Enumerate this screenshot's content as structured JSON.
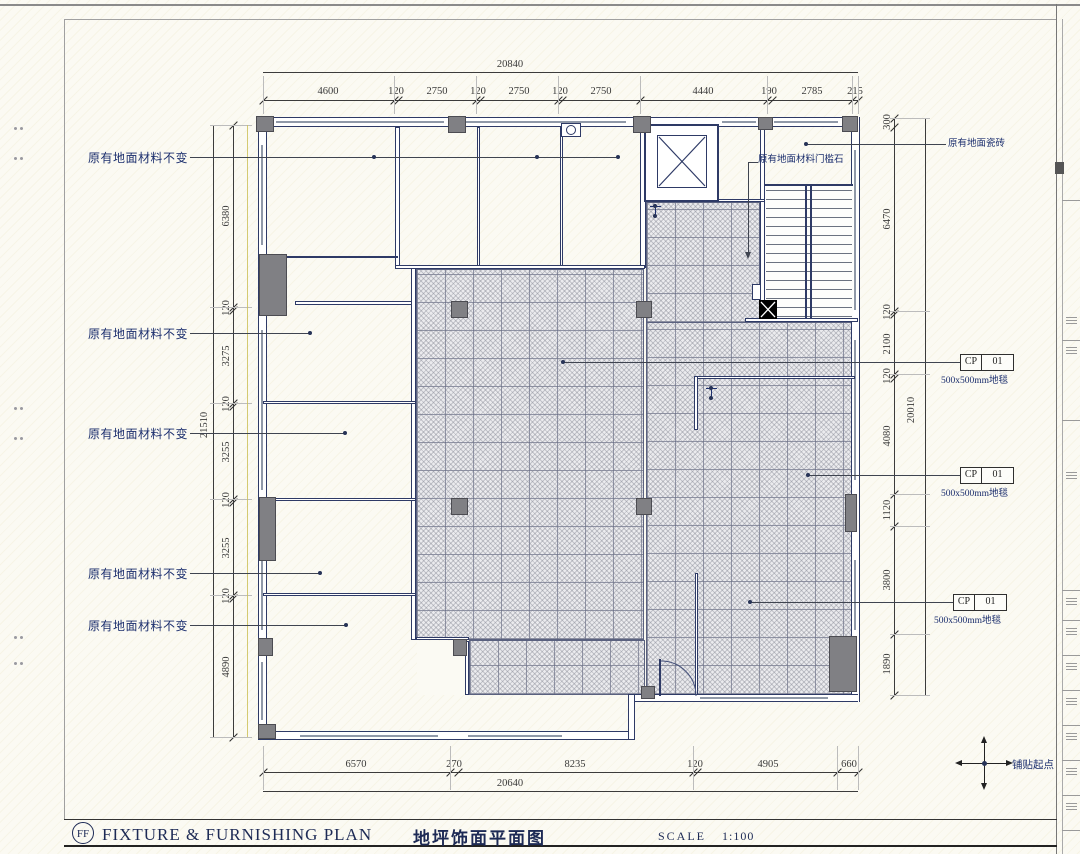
{
  "sheet": {
    "title_tag": "FF",
    "title_en": "FIXTURE  &  FURNISHING  PLAN",
    "title_cn": "地坪饰面平面图",
    "scale_label": "SCALE",
    "scale_value": "1:100"
  },
  "dims": {
    "top": {
      "overall": "20840",
      "segments": [
        "4600",
        "120",
        "2750",
        "120",
        "2750",
        "120",
        "2750",
        "4440",
        "190",
        "2785",
        "215"
      ]
    },
    "bottom": {
      "overall": "20640",
      "segments": [
        "6570",
        "270",
        "8235",
        "120",
        "4905",
        "660"
      ]
    },
    "left": {
      "overall": "21510",
      "segments": [
        "6380",
        "120",
        "3275",
        "120",
        "3255",
        "120",
        "3255",
        "120",
        "4890"
      ]
    },
    "right": {
      "overall": "20010",
      "segments": [
        "300",
        "6470",
        "120",
        "2100",
        "120",
        "4080",
        "1120",
        "3800",
        "1890"
      ]
    }
  },
  "labels": {
    "unchanged_floor": "原有地面材料不变",
    "unchanged_floor_count": 5,
    "existing_tile": "原有地面瓷砖",
    "threshold": "原有地面材料门槛石",
    "carpet_tag_code": "CP",
    "carpet_tag_num": "01",
    "carpet_desc": "500x500mm地毯",
    "carpet_tag_count": 3,
    "paving_start": "铺贴起点"
  },
  "colors": {
    "wall": "#2e3a66",
    "column": "#808084",
    "dimension": "#3c3c3c",
    "label_text": "#1c2f6e",
    "hatch_bg": "#ebebee"
  }
}
